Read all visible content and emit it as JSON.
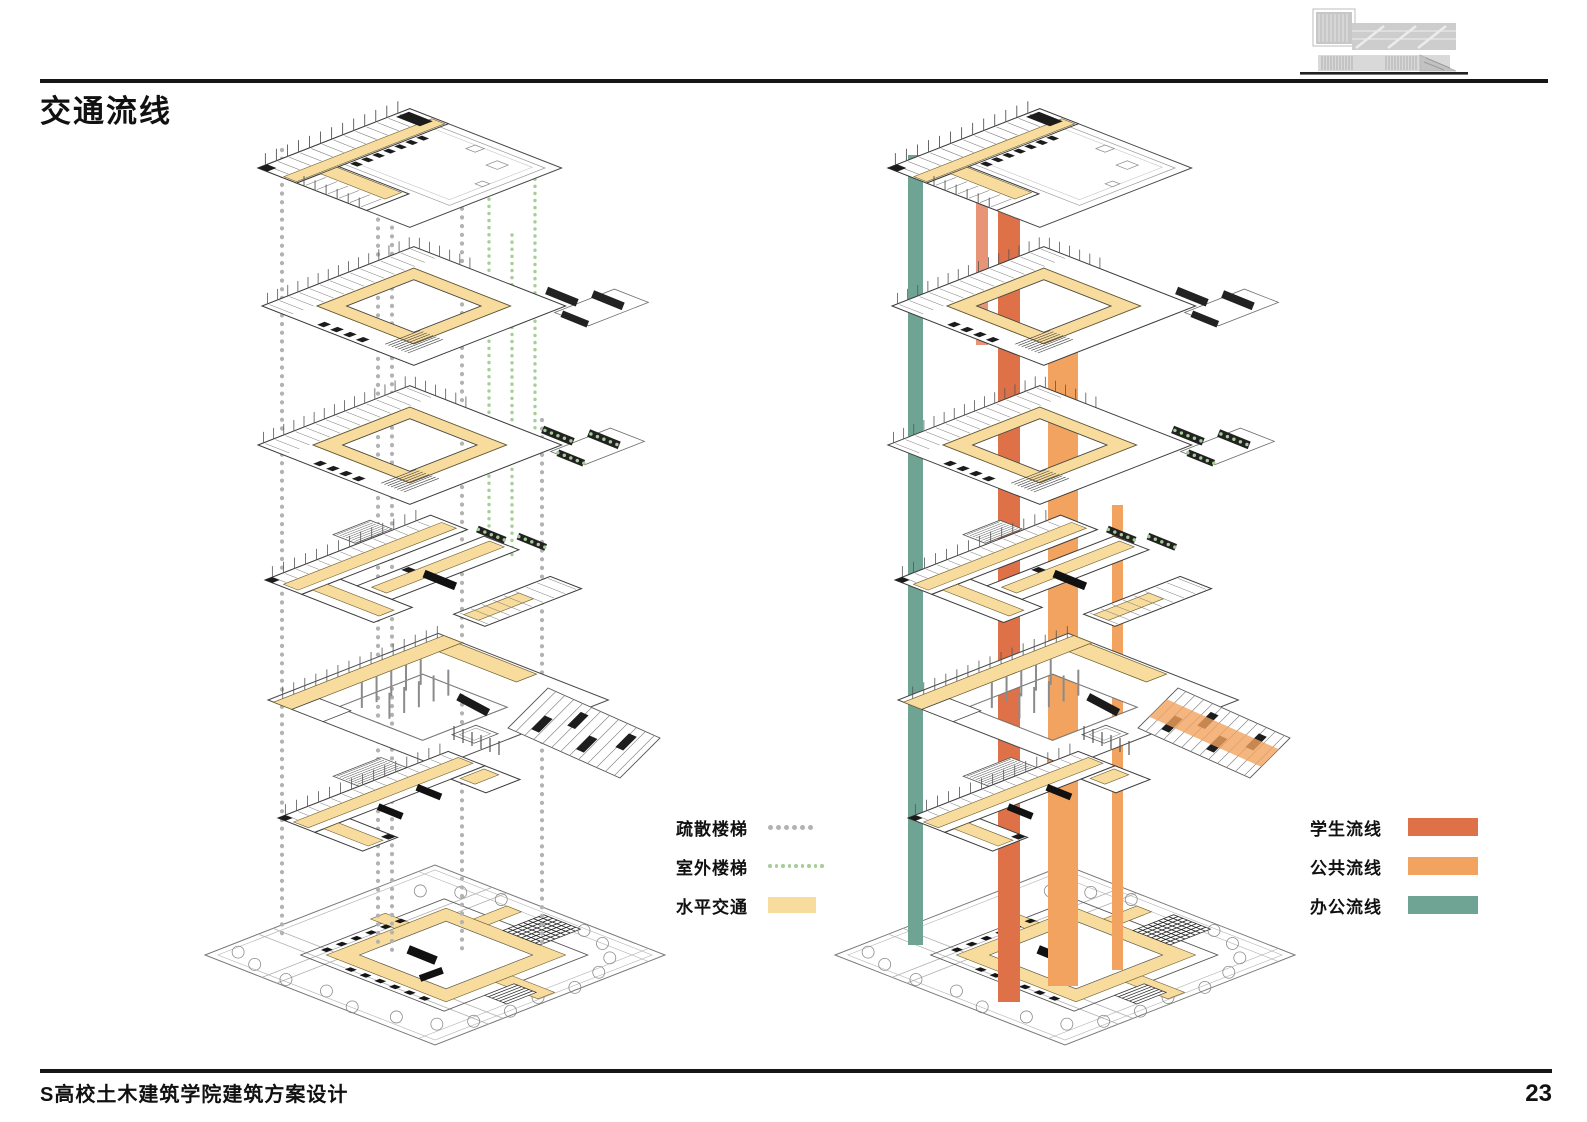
{
  "page": {
    "title": "交通流线",
    "footer": "S高校土木建筑学院建筑方案设计",
    "page_number": "23"
  },
  "legend_left": {
    "items": [
      {
        "label": "疏散楼梯",
        "symbol": "gray-dotted-line",
        "color": "#b2b2b2",
        "dots": 6,
        "dot_size": 5
      },
      {
        "label": "室外楼梯",
        "symbol": "green-dotted-line",
        "color": "#a6ce97",
        "dots": 9,
        "dot_size": 3.5
      },
      {
        "label": "水平交通",
        "symbol": "yellow-swatch",
        "color": "#f8dc9d"
      }
    ]
  },
  "legend_right": {
    "items": [
      {
        "label": "学生流线",
        "symbol": "red-swatch",
        "color": "#df7148"
      },
      {
        "label": "公共流线",
        "symbol": "orange-swatch",
        "color": "#f1a35f"
      },
      {
        "label": "办公流线",
        "symbol": "teal-swatch",
        "color": "#6fa495"
      }
    ]
  },
  "colors": {
    "corridor": "#f8dc9d",
    "corridor_edge": "#6b5c2e",
    "line_dark": "#3c3c3c",
    "gray_dot": "#b2b2b2",
    "green_dot": "#a6ce97",
    "student_red": "#df7148",
    "public_orange": "#f1a35f",
    "office_teal": "#6fa495"
  },
  "diagrams": [
    {
      "name": "exploded-axon-circulation-left",
      "dx": 0,
      "guides": {
        "gray": {
          "xs": [
            282,
            378,
            392,
            462,
            542
          ],
          "ranges": [
            [
              150,
              940
            ],
            [
              150,
              950
            ],
            [
              158,
              950
            ],
            [
              200,
              952
            ],
            [
              420,
              948
            ]
          ]
        },
        "green": {
          "xs": [
            489,
            512,
            535
          ],
          "ranges": [
            [
              185,
              555
            ],
            [
              235,
              555
            ],
            [
              165,
              430
            ]
          ]
        }
      },
      "bands": [],
      "ramp_overlay": false
    },
    {
      "name": "exploded-axon-circulation-right",
      "dx": 630,
      "guides": null,
      "bands": [
        {
          "name": "office-flow-band",
          "color": "#6fa495",
          "x": 908,
          "w": 15,
          "y1": 155,
          "y2": 945,
          "opacity": 1
        },
        {
          "name": "student-flow-band-secondary",
          "color": "#df7148",
          "x": 976,
          "w": 12,
          "y1": 180,
          "y2": 345,
          "opacity": 0.75
        },
        {
          "name": "student-flow-band",
          "color": "#df7148",
          "x": 998,
          "w": 22,
          "y1": 175,
          "y2": 1002,
          "opacity": 1
        },
        {
          "name": "public-flow-band",
          "color": "#f1a35f",
          "x": 1048,
          "w": 30,
          "y1": 340,
          "y2": 986,
          "opacity": 1
        },
        {
          "name": "public-flow-band-narrow",
          "color": "#f1a35f",
          "x": 1112,
          "w": 11,
          "y1": 505,
          "y2": 970,
          "opacity": 1
        }
      ],
      "ramp_overlay": true
    }
  ],
  "floors": [
    {
      "kind": "roof",
      "anchor": [
        258,
        168
      ],
      "name": "roof-level-plan"
    },
    {
      "kind": "ring",
      "anchor": [
        262,
        306
      ],
      "stair": "dark",
      "name": "fifth-floor-plan"
    },
    {
      "kind": "ring",
      "anchor": [
        258,
        445
      ],
      "stair": "green",
      "name": "fourth-floor-plan"
    },
    {
      "kind": "ushape",
      "anchor": [
        265,
        580
      ],
      "name": "third-floor-plan"
    },
    {
      "kind": "terrace",
      "anchor": [
        268,
        700
      ],
      "name": "second-floor-plan"
    },
    {
      "kind": "bar",
      "anchor": [
        278,
        818
      ],
      "name": "first-floor-plan"
    },
    {
      "kind": "site",
      "anchor": [
        205,
        955
      ],
      "name": "ground-site-plan"
    }
  ]
}
